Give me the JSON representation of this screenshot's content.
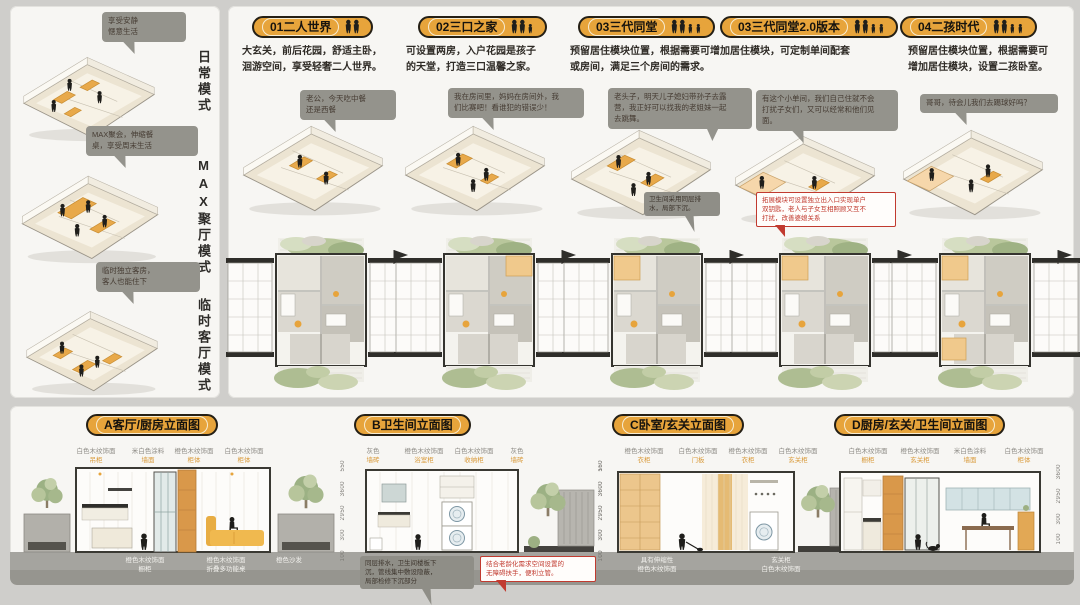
{
  "colors": {
    "accent": "#e7a43b",
    "bubble_bg": "#94938c",
    "note_red": "#c13a2f",
    "ground": "#a5a49f",
    "wood_orange": "#d9984a"
  },
  "left_panel": {
    "modes": [
      {
        "callout": "享受安静\n惬意生活",
        "label": "日常模式"
      },
      {
        "callout": "MAX聚会，伸缩餐\n桌，享受周末生活",
        "label": "MAX聚厅模式"
      },
      {
        "callout": "临时独立客房，\n客人也能住下",
        "label": "临时客厅模式"
      }
    ]
  },
  "main_panel": {
    "columns": [
      {
        "header": "01二人世界",
        "icon_people": 2,
        "desc": "大玄关，前后花园，舒适主卧，\n洄游空间，享受轻奢二人世界。",
        "bubble": "老公，今天吃中餐\n还是西餐"
      },
      {
        "header": "02三口之家",
        "icon_people": 3,
        "desc": "可设置两房，入户花园是孩子\n的天堂，打造三口温馨之家。",
        "bubble": "我在房间里，妈妈在房间外，我\n们比赛吧！看谁犯的错误少！"
      },
      {
        "header": "03三代同堂",
        "icon_people": 4,
        "desc": "预留居住模块位置，根据需要可增加居住模块，可定制单间配套\n或房间，满足三个房间的需求。",
        "bubble": "老头子，明天儿子媳妇带孙子去露\n营，我正好可以找我的老姐妹一起\n去跳舞。",
        "note_dark": "卫生间采用同层排\n水，局部下沉。",
        "note_red": "拓展模块可设置独立出入口实现单户\n双钥匙，老人与子女互相照顾又互不\n打扰，改善婆媳关系"
      },
      {
        "header": "03三代同堂2.0版本",
        "icon_people": 4,
        "bubble": "有这个小单间，我们自己住就不会\n打扰子女们，又可以经常和他们见\n面。"
      },
      {
        "header": "04二孩时代",
        "icon_people": 4,
        "desc": "预留居住模块位置，根据需要可\n增加居住模块，设置二孩卧室。",
        "bubble": "哥哥，待会儿我们去踢球好吗？"
      }
    ]
  },
  "bottom_panel": {
    "elevations": [
      {
        "title": "A客厅/厨房立面图",
        "top_labels": [
          {
            "main": "白色木纹饰面",
            "sub": "吊柜"
          },
          {
            "main": "米白色涂料",
            "sub": "墙面"
          },
          {
            "main": "橙色木纹饰面",
            "sub": "柜体"
          },
          {
            "main": "白色木纹饰面",
            "sub": "柜体"
          }
        ],
        "bottom_labels": [
          "橙色木纹饰面\n橱柜",
          "橙色木纹饰面\n折叠多功能桌",
          "橙色沙发"
        ],
        "dims": [
          "550",
          "3600",
          "2950",
          "300",
          "100"
        ]
      },
      {
        "title": "B卫生间立面图",
        "top_labels": [
          {
            "main": "灰色",
            "sub": "墙砖"
          },
          {
            "main": "橙色木纹饰面",
            "sub": "浴室柜"
          },
          {
            "main": "白色木纹饰面",
            "sub": "收纳柜"
          },
          {
            "main": "灰色",
            "sub": "墙砖"
          }
        ],
        "note_dark": "同层排水，卫生间楼板下\n沉，管线集中敷设隐蔽，\n局部检修下沉部分",
        "note_red": "结合老龄化需求空间设置的\n无障碍扶手，便利立管。",
        "dims": [
          "160",
          "3600",
          "2950",
          "300",
          "100"
        ]
      },
      {
        "title": "C卧室/玄关立面图",
        "top_labels": [
          {
            "main": "橙色木纹饰面",
            "sub": "衣柜"
          },
          {
            "main": "白色木纹饰面",
            "sub": "门板"
          },
          {
            "main": "橙色木纹饰面",
            "sub": "衣柜"
          },
          {
            "main": "白色木纹饰面",
            "sub": "玄关柜"
          }
        ],
        "bottom_labels": [
          "具有伸缩性\n橙色木纹饰面",
          "玄关柜\n白色木纹饰面"
        ],
        "dims": [
          "550",
          "3600",
          "2950",
          "300",
          "100"
        ]
      },
      {
        "title": "D厨房/玄关/卫生间立面图",
        "top_labels": [
          {
            "main": "白色木纹饰面",
            "sub": "橱柜"
          },
          {
            "main": "橙色木纹饰面",
            "sub": "玄关柜"
          },
          {
            "main": "米白色涂料",
            "sub": "墙面"
          },
          {
            "main": "白色木纹饰面",
            "sub": "柜体"
          }
        ],
        "dims": [
          "3600",
          "2950",
          "300",
          "100"
        ]
      }
    ]
  }
}
